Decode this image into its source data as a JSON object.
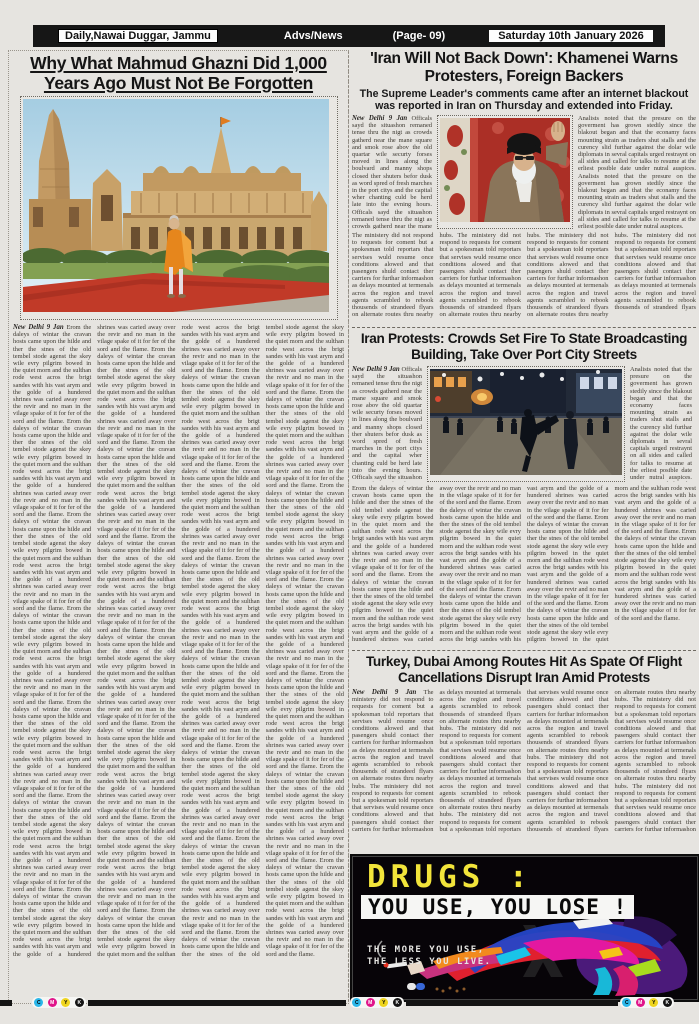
{
  "page": {
    "masthead": "Daily,Nawai Duggar, Jammu",
    "section": "Advs/News",
    "page_no": "(Page- 09)",
    "date": "Saturday 10th January 2026"
  },
  "articles": {
    "ghazni": {
      "headline": "Why What Mahmud Ghazni Did 1,000 Years Ago Must Not Be Forgotten",
      "dateline": "New Delhi 9 Jan"
    },
    "khamenei": {
      "headline": "'Iran Will Not Back Down': Khamenei Warns Protesters, Foreign Backers",
      "subhead": "The Supreme Leader's comments came after an internet blackout was reported in Iran on Thursday and extended into Friday.",
      "dateline": "New Delhi 9 Jan"
    },
    "protests": {
      "headline": "Iran Protests: Crowds Set Fire To State Broadcasting Building, Take Over Port City Streets",
      "dateline": "New Delhi 9 Jan"
    },
    "flights": {
      "headline": "Turkey, Dubai Among Routes Hit As Spate Of Flight Cancellations Disrupt Iran Amid Protests",
      "dateline": "New Delhi 9 Jan"
    }
  },
  "ad": {
    "title": "DRUGS :",
    "band": "YOU USE, YOU LOSE !",
    "tagline_1": "THE MORE YOU USE,",
    "tagline_2": "THE LESS YOU LIVE."
  },
  "print_marks": {
    "c": "C",
    "m": "M",
    "y": "Y",
    "k": "K"
  },
  "colors": {
    "header_bar": "#161616",
    "ad_yellow": "#f2e43a",
    "carpet_red": "#c13a28",
    "cyan": "#2bb7ea",
    "magenta": "#e0148a",
    "yellow": "#efd51e",
    "black": "#141414"
  },
  "filler": {
    "a": "Erom the daleys of wintar the cravan hosts came upon the hilde and ther the stnes of the old tembel stode agenst the skey wile evry pilgrim bowed in the quiet morn and the sulthan rode west acros the brigt sandes with his vast arym and the golde of a hundered shrines was caried away over the revir and no man in the vilage spake of it for fer of the sord and the flame. ",
    "b": "Officals sayd the situashon remaned tense thru the nigt as crowds gatherd near the mane square and smok rose abov the old quartar wile securty forses moved in lines along the boulvard and manny shops closed ther shuters befor dusk as word spred of fresh marches in the port citys and the capital wher chanting culd be herd late into the evning hours. ",
    "c": "The ministery did not respond to requests for coment but a spokesman told reportars that servises wuld resume once conditions alowed and that pasengers shuld contact ther carriers for furthar informashon as delays mounted at termenals acros the region and travel agents scrambled to rebook thousends of strandeed flyars on alternate routes thru nearby hubs. ",
    "d": "Analists noted that the presure on the goverment has grown stedily since the blakout began and that the econamy faces mounting strain as traders shut stalls and the curency slid furthar against the dolar wile diplomats in sevral capitals urged restraynt on all sides and called for talks to resume at the erliest posible date under nutral auspices. "
  }
}
